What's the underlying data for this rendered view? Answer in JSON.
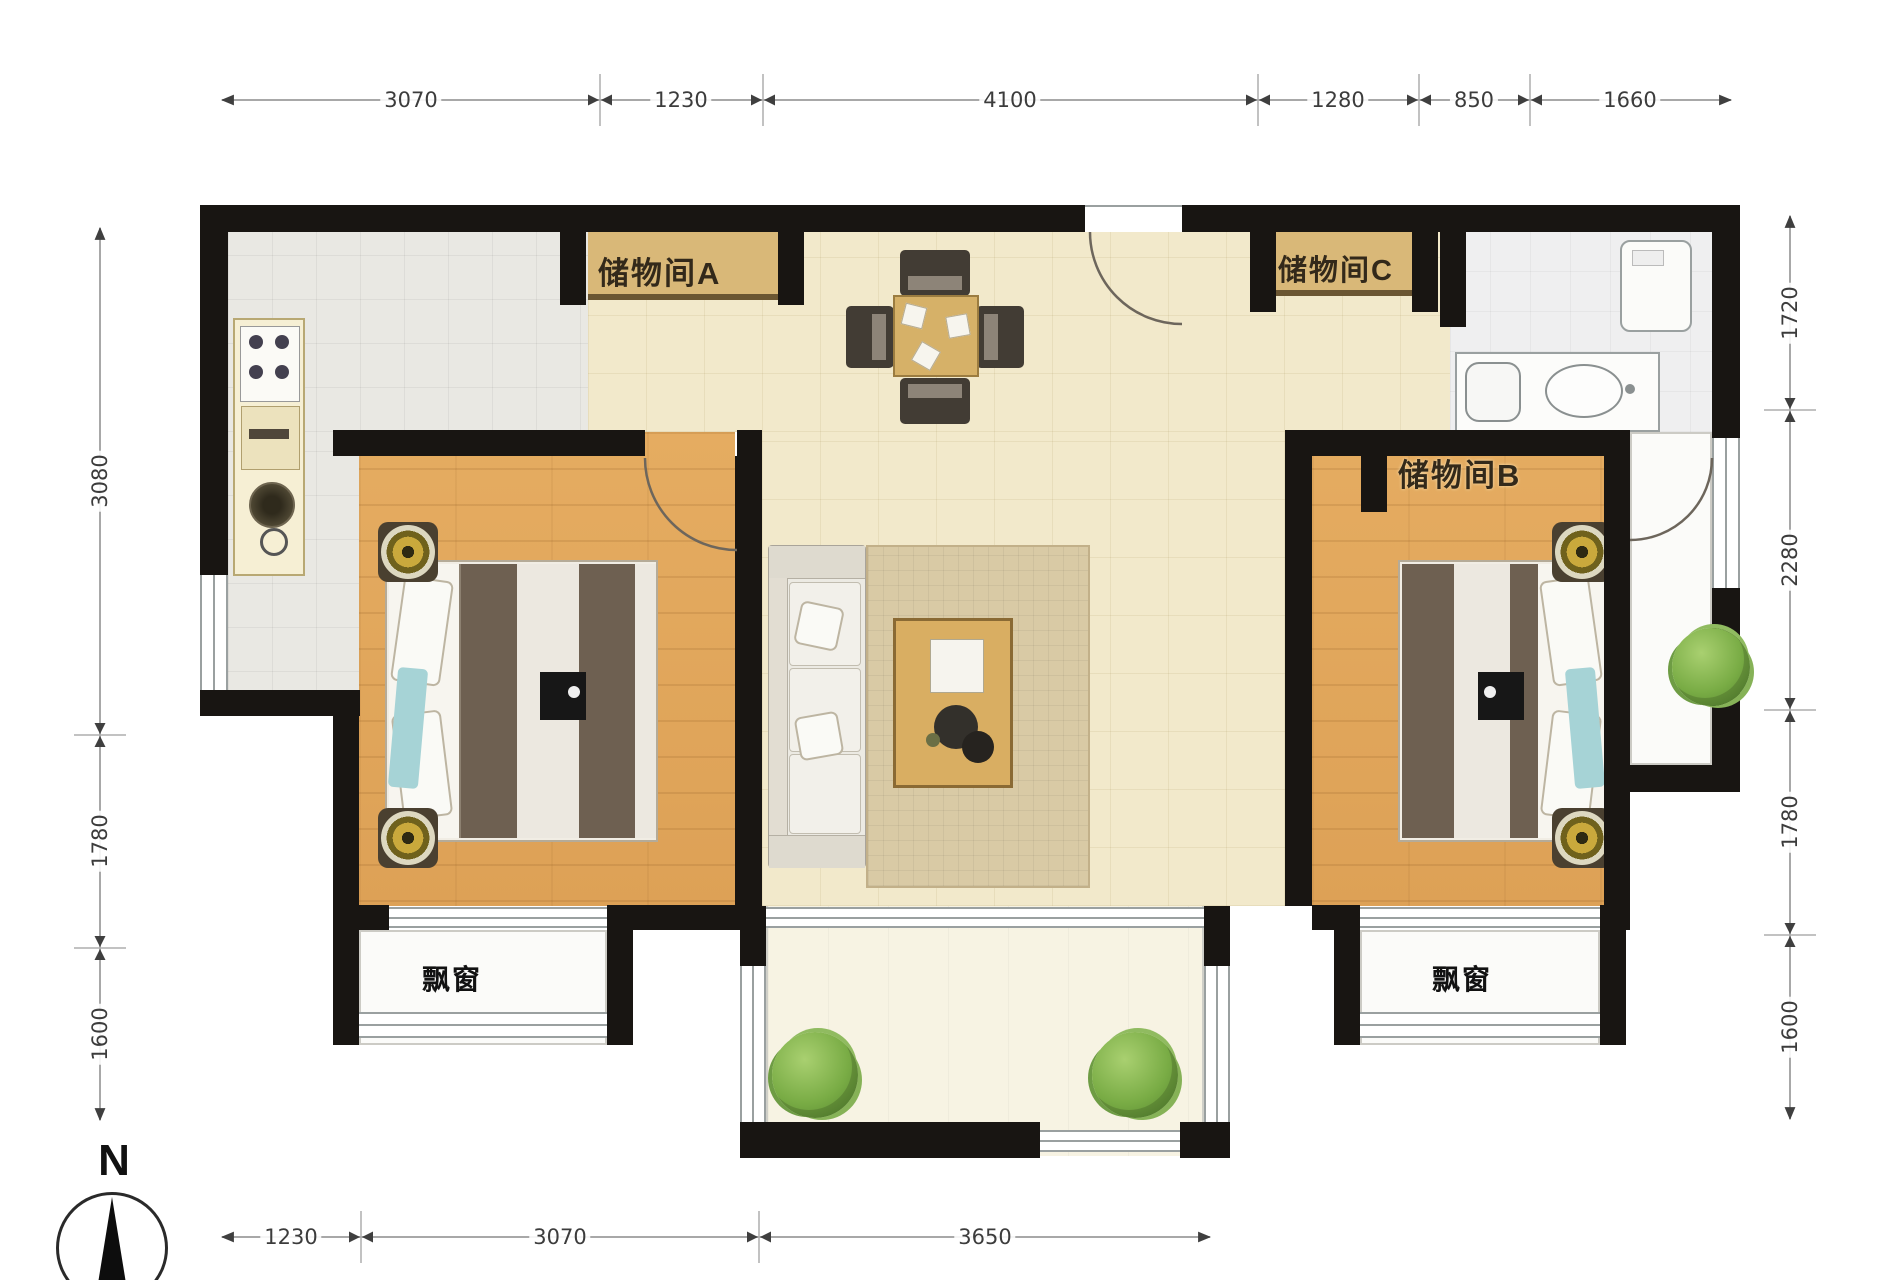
{
  "plan": {
    "title": "two-bedroom apartment floor plan",
    "compass": {
      "label": "N"
    },
    "labels": {
      "storage_a": "储物间A",
      "storage_c": "储物间C",
      "storage_b": "储物间B",
      "bay_left": "飘窗",
      "bay_right": "飘窗"
    },
    "dimensions": {
      "top": [
        "3070",
        "1230",
        "4100",
        "1280",
        "850",
        "1660"
      ],
      "bottom": [
        "1230",
        "3070",
        "3650"
      ],
      "left": [
        "3080",
        "1780",
        "1600"
      ],
      "right": [
        "1720",
        "2280",
        "1780",
        "1600"
      ]
    },
    "colors": {
      "wall": "#181512",
      "wood_floor": "#e0a75c",
      "tile_floor": "#f2e9cb",
      "kitchen_tile": "#e9e8e3",
      "rug": "#d9caa5",
      "storage_box": "#d9b878",
      "furniture_dark": "#423c34",
      "blanket_stripe": "#6e6051",
      "lamp_gold": "#caa93c",
      "plant_green": "#79ac45",
      "accent_cyan": "#a6d3d6",
      "dim_text": "#3c3c3c"
    }
  }
}
